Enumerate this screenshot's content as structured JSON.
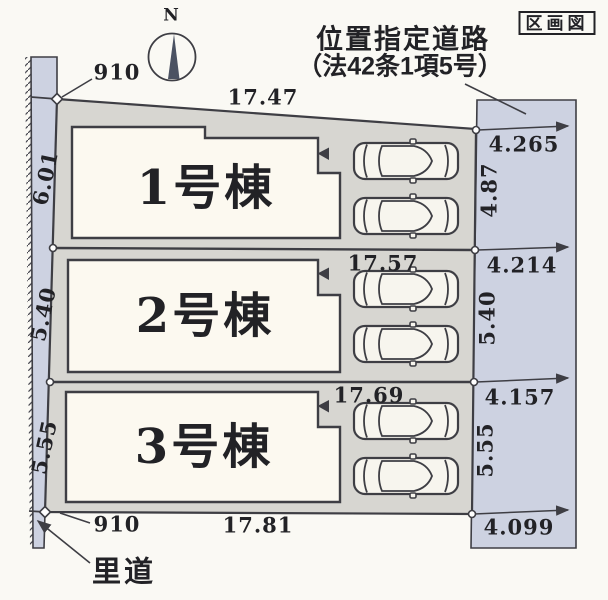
{
  "header": {
    "plan_type_label": "区画図"
  },
  "compass": {
    "label": "N"
  },
  "top_road": {
    "name_line1": "位置指定道路",
    "name_line2": "（法42条1項5号）"
  },
  "left_road": {
    "name": "里道"
  },
  "buildings": [
    {
      "label": "1号棟"
    },
    {
      "label": "2号棟"
    },
    {
      "label": "3号棟"
    }
  ],
  "dimensions": {
    "top_offset": "910",
    "bottom_offset": "910",
    "top_width": "17.47",
    "row2_width": "17.57",
    "row3_width": "17.69",
    "bottom_width": "17.81",
    "left_depths": [
      "6.01",
      "5.40",
      "5.55"
    ],
    "right_depths": [
      "4.87",
      "5.40",
      "5.55"
    ],
    "right_road_widths": [
      "4.265",
      "4.214",
      "4.157",
      "4.099"
    ]
  },
  "icons": {
    "compass": "north-compass-icon",
    "car": "car-top-view-icon",
    "entrance_marker": "entrance-arrow-icon"
  },
  "colors": {
    "page": "#faf9f4",
    "plot": "#d7d6d1",
    "road": "#cdd2e1",
    "bldg": "#fcf9f0",
    "line": "#3e3e44",
    "text": "#222226"
  }
}
